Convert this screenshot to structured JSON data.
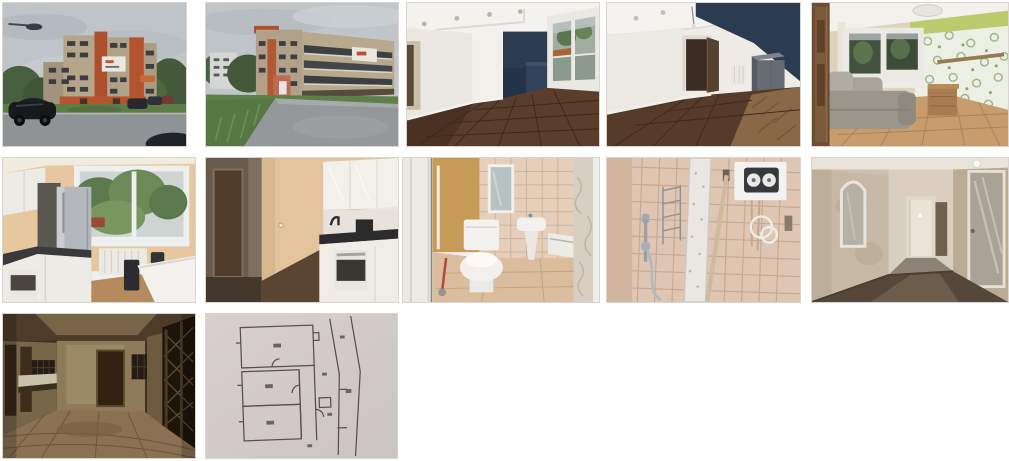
{
  "page": {
    "background_color": "#ffffff"
  },
  "gallery": {
    "layout": {
      "columns": 5,
      "rows": 3,
      "visible_count": 12
    },
    "thumb_border_color": "#d9d4cc",
    "items": [
      {
        "id": "building-exterior-front",
        "label": "Apartment building exterior, street view with parked cars"
      },
      {
        "id": "building-exterior-side",
        "label": "Apartment building exterior, side view from driveway"
      },
      {
        "id": "living-room-accent-wall",
        "label": "Empty living room with dark accent wall and window"
      },
      {
        "id": "living-room-doorway",
        "label": "Empty living room with doorway and dark feature wall"
      },
      {
        "id": "room-sofa-wallpaper",
        "label": "Room with sofa, window and green floral wallpaper"
      },
      {
        "id": "kitchen-fridge-window",
        "label": "Kitchen with fridge, window and white cabinets"
      },
      {
        "id": "kitchen-oven",
        "label": "Kitchen with white cabinets, oven and dark countertop"
      },
      {
        "id": "bathroom-toilet",
        "label": "Bathroom with toilet, sink and mirror"
      },
      {
        "id": "shower-water-heater",
        "label": "Tiled shower corner with water heater"
      },
      {
        "id": "hallway-mirror",
        "label": "Hallway with mirror and glass door"
      },
      {
        "id": "entrance-hall",
        "label": "Building entrance hall with mailboxes"
      },
      {
        "id": "floor-plan",
        "label": "Apartment floor plan drawing"
      }
    ]
  }
}
